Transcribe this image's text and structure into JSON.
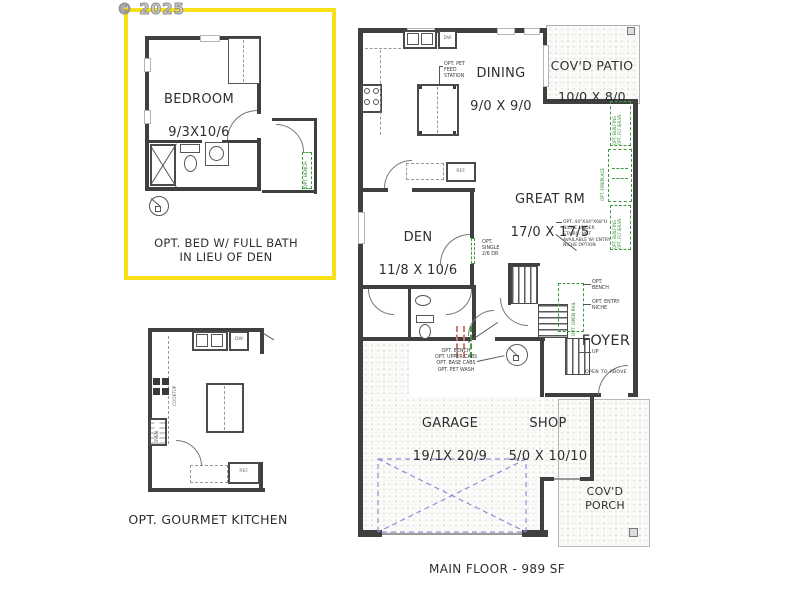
{
  "watermark": "© 2025",
  "footer": "MAIN FLOOR - 989 SF",
  "colors": {
    "accent_yellow": "#f7df17",
    "option_green": "#3f9b3f",
    "clearance_blue": "#8e8ed8",
    "wall_gray": "#3f3f3f"
  },
  "insets": {
    "bedroom": {
      "name": "BEDROOM",
      "dims": "9/3X10/6",
      "caption": "OPT. BED W/ FULL BATH\nIN LIEU OF DEN",
      "opt_bench": "OPT. BENCH"
    },
    "kitchen": {
      "caption": "OPT. GOURMET KITCHEN",
      "dw": "DW",
      "cooktop": "COOKTOP",
      "oven": "OVEN",
      "ref": "REF."
    }
  },
  "plan": {
    "dining": {
      "name": "DINING",
      "dims": "9/0 X 9/0"
    },
    "patio": {
      "name": "COV'D PATIO",
      "dims": "10/0 X 8/0"
    },
    "great_rm": {
      "name": "GREAT RM",
      "dims": "17/0 X 17/5"
    },
    "den": {
      "name": "DEN",
      "dims": "11/8 X 10/6"
    },
    "foyer": {
      "name": "FOYER",
      "sub": "OPEN TO ABOVE"
    },
    "garage": {
      "name": "GARAGE",
      "dims": "19/1X 20/9"
    },
    "shop": {
      "name": "SHOP",
      "dims": "5/0 X 10/10"
    },
    "porch": {
      "name": "COV'D\nPORCH"
    },
    "labels": {
      "dw": "DW",
      "ref": "REF.",
      "up": "UP"
    },
    "options": {
      "pet_feed": "OPT. PET\nFEED\nSTATION",
      "single_door": "OPT.\nSINGLE\n2/6 DR",
      "stair_niche": "OPT. 44\"X44\"X68\"H\nNICHE UNDER\nSTAIRS. NOT\nAVAILABLE W/ ENTRY\nNICHE OPTION",
      "bench": "OPT.\nBENCH",
      "entry_niche": "OPT. ENTRY\nNICHE",
      "open_rail": "OPT. OPEN RAIL",
      "mudroom": "OPT. BENCH\nOPT. UPPER CABS\nOPT. BASE CABS\nOPT. PET WASH",
      "builtins_upper": "OPT. BUILT-INS\nOPT. FLT SHLVS",
      "fireplace": "OPT. FIREPLACE",
      "builtins_lower": "OPT. BUILT-INS\nOPT. FLT SHLVS"
    }
  }
}
